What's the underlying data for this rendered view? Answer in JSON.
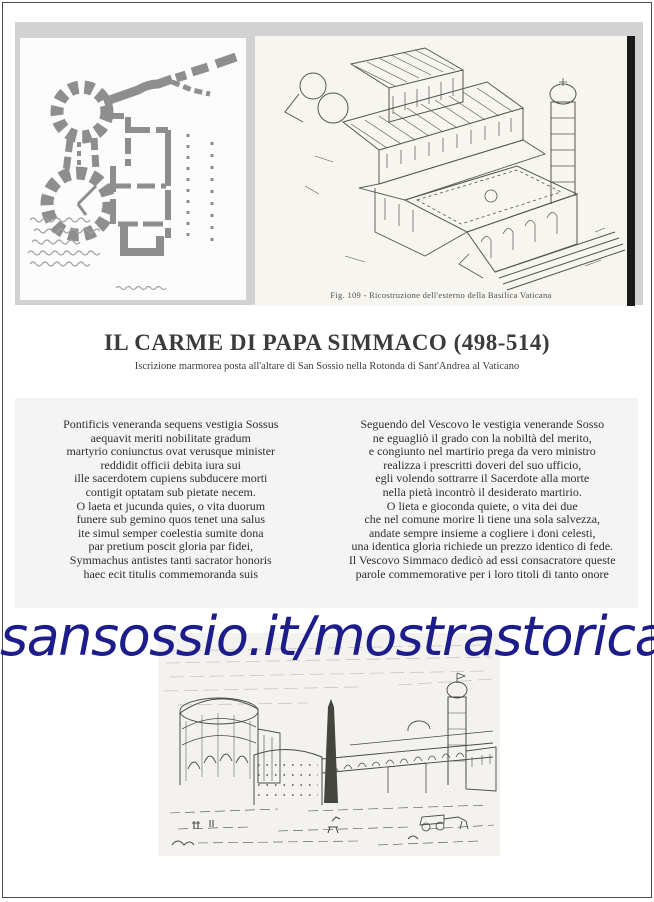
{
  "title": {
    "heading": "IL CARME DI PAPA SIMMACO (498-514)",
    "subtitle": "Iscrizione marmorea posta all'altare di San Sossio nella Rotonda di Sant'Andrea al Vaticano"
  },
  "header_figures": {
    "background": "#d2d2d2",
    "plan_image_alt": "hand-drawn floor plan sketch with handwritten notes",
    "basilica_image_alt": "engraved reconstruction of the old Vatican basilica",
    "basilica_caption": "Fig. 109 - Ricostruzione dell'esterno della Basilica Vaticana"
  },
  "poem": {
    "latin_lines": [
      "Pontificis veneranda sequens vestigia Sossus",
      "aequavit meriti nobilitate gradum",
      "martyrio coniunctus ovat verusque minister",
      "reddidit officii debita iura sui",
      "ille sacerdotem cupiens subducere morti",
      "contigit optatam sub pietate necem.",
      "O laeta et jucunda quies, o vita duorum",
      "funere sub gemino quos tenet una salus",
      "ite simul semper coelestia sumite dona",
      "par pretium poscit gloria par fidei,",
      "Symmachus antistes tanti sacrator honoris",
      "haec ecit titulis commemoranda suis"
    ],
    "italian_lines": [
      "Seguendo del Vescovo le vestigia venerande Sosso",
      "ne eguagliò il grado con la nobiltà del merito,",
      "e congiunto nel martirio prega da vero ministro",
      "realizza i prescritti doveri del suo ufficio,",
      "egli volendo sottrarre il Sacerdote alla morte",
      "nella pietà incontrò il desiderato martirio.",
      "O lieta e gioconda quiete, o vita dei due",
      "che nel comune morire li tiene una sola salvezza,",
      "andate sempre insieme a cogliere i doni celesti,",
      "una identica gloria richiede un prezzo identico di fede.",
      "Il Vescovo Simmaco dedicò ad essi consacratore queste",
      "parole commemorative per i loro titoli di tanto onore"
    ]
  },
  "url_banner": {
    "text": "sansossio.it/mostrastorica",
    "color": "#1c1c8a"
  },
  "footer_image": {
    "alt": "engraved cityscape with round ruin, obelisk and tower"
  }
}
